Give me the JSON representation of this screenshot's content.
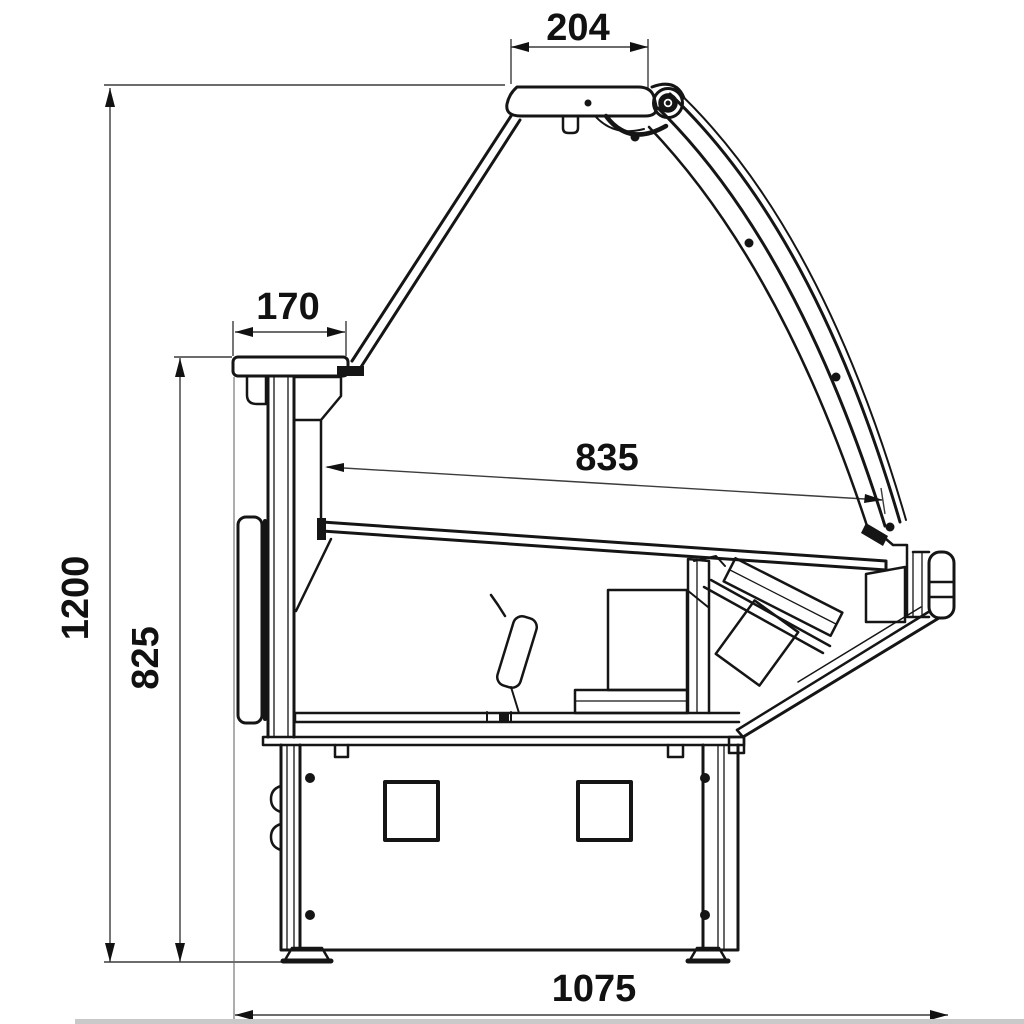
{
  "drawing": {
    "type": "side-section technical drawing of a serve-over refrigerated display counter",
    "parts": [
      "canopy",
      "hinge",
      "curved-front-glass",
      "rear-flat-glass",
      "worktop-shelf",
      "rear-wall",
      "display-deck",
      "well-floor",
      "interior-divider-flap",
      "machine-box",
      "front-inner-wall",
      "front-slanted-panel",
      "front-bumper",
      "base-plinth",
      "ventilation-grilles",
      "adjustable-feet"
    ]
  },
  "dimensions": {
    "canopy_depth": {
      "value": "204",
      "orientation": "horizontal"
    },
    "worktop_depth": {
      "value": "170",
      "orientation": "horizontal"
    },
    "display_deck_depth": {
      "value": "835",
      "orientation": "horizontal-sloped"
    },
    "overall_height": {
      "value": "1200",
      "orientation": "vertical"
    },
    "worktop_height": {
      "value": "825",
      "orientation": "vertical"
    },
    "overall_depth": {
      "value": "1075",
      "orientation": "horizontal"
    }
  },
  "colors": {
    "line": "#151515",
    "dimension_line": "#3c3c3c",
    "text": "#111111",
    "background": "#ffffff",
    "bottom_strip": "#c9c9c9"
  }
}
